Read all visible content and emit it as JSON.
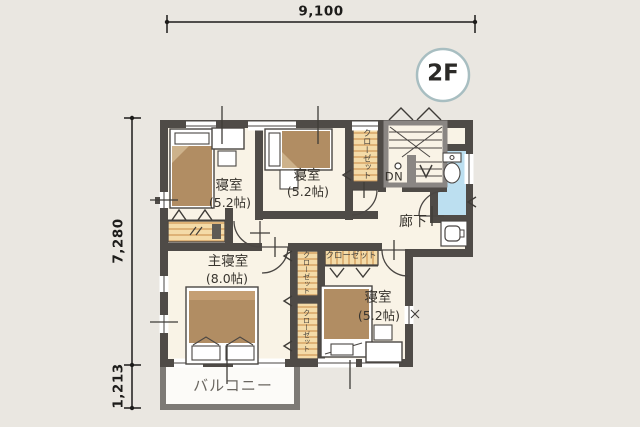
{
  "floor_badge": "2F",
  "dimensions": {
    "width_total": "9,100",
    "height_main": "7,280",
    "height_balcony": "1,213"
  },
  "rooms": {
    "bedroom_nw": {
      "name": "寝室",
      "size": "(5.2帖)"
    },
    "bedroom_n": {
      "name": "寝室",
      "size": "(5.2帖)"
    },
    "master_bedroom": {
      "name": "主寝室",
      "size": "(8.0帖)"
    },
    "bedroom_se": {
      "name": "寝室",
      "size": "(5.2帖)"
    },
    "hallway": {
      "name": "廊下"
    },
    "balcony": {
      "name": "バルコニー"
    }
  },
  "closets": {
    "north": "クローゼット",
    "master_upper": "クローゼット",
    "master_lower": "クローゼット",
    "southeast": "クローゼット"
  },
  "stairs": {
    "label": "DN"
  },
  "colors": {
    "background": "#eae7e1",
    "floor": "#f9f3e6",
    "wall": "#4f4b47",
    "stair_frame": "#8a8683",
    "bed_tan": "#b18d63",
    "closet_tan": "#f4dba8",
    "closet_stripe": "#d8a76a",
    "toilet_blue": "#bcdff0",
    "balcony_wall": "#7d7a76",
    "badge_ring": "#a8bec1"
  }
}
